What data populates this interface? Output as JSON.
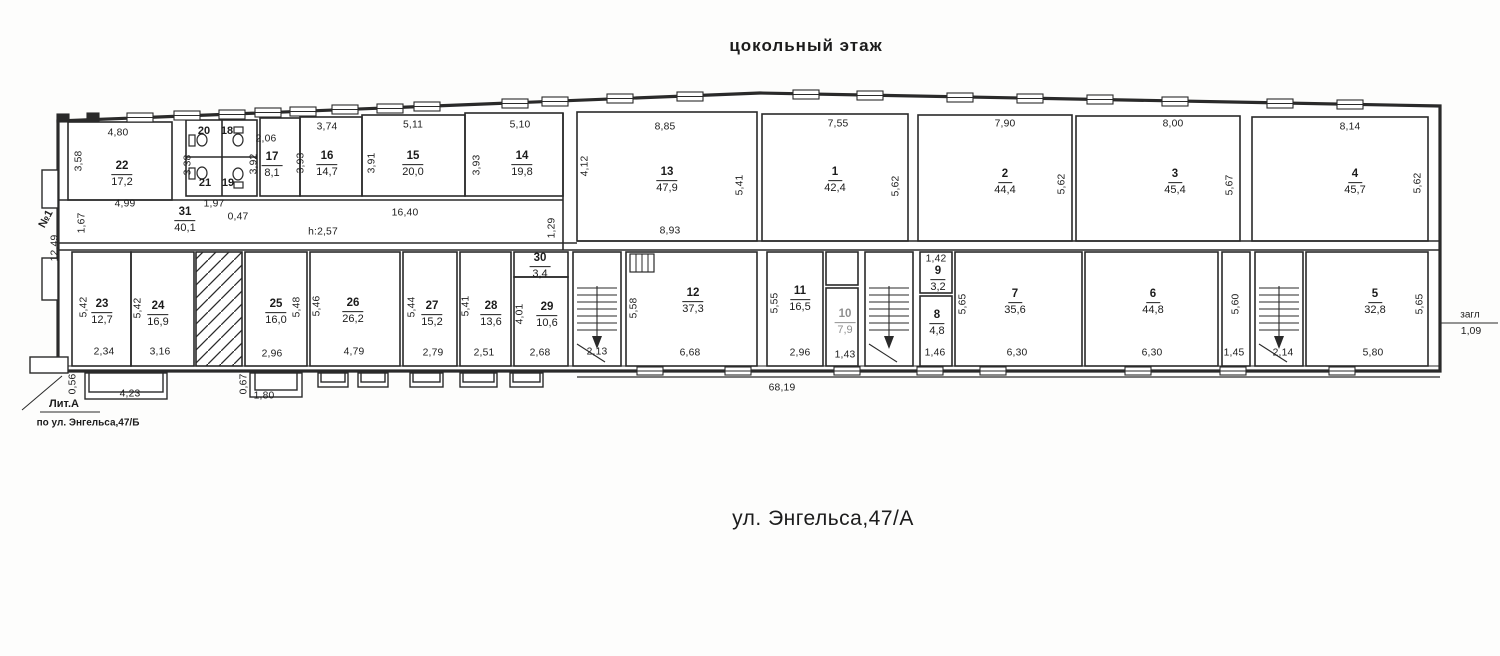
{
  "title": "цокольный  этаж",
  "address": "ул. Энгельса,47/А",
  "annotations": {
    "lit": "Лит.А",
    "street_b": "по ул. Энгельса,47/Б",
    "entrance": "№1",
    "zagl_text": "загл",
    "zagl_value": "1,09"
  },
  "rooms": [
    {
      "n": "22",
      "a": "17,2",
      "x": 122,
      "y": 172
    },
    {
      "n": "17",
      "a": "8,1",
      "x": 272,
      "y": 163
    },
    {
      "n": "16",
      "a": "14,7",
      "x": 327,
      "y": 162
    },
    {
      "n": "15",
      "a": "20,0",
      "x": 413,
      "y": 162
    },
    {
      "n": "14",
      "a": "19,8",
      "x": 522,
      "y": 162
    },
    {
      "n": "13",
      "a": "47,9",
      "x": 667,
      "y": 178
    },
    {
      "n": "1",
      "a": "42,4",
      "x": 835,
      "y": 178
    },
    {
      "n": "2",
      "a": "44,4",
      "x": 1005,
      "y": 180
    },
    {
      "n": "3",
      "a": "45,4",
      "x": 1175,
      "y": 180
    },
    {
      "n": "4",
      "a": "45,7",
      "x": 1355,
      "y": 180
    },
    {
      "n": "31",
      "a": "40,1",
      "x": 185,
      "y": 218
    },
    {
      "n": "23",
      "a": "12,7",
      "x": 102,
      "y": 310
    },
    {
      "n": "24",
      "a": "16,9",
      "x": 158,
      "y": 312
    },
    {
      "n": "25",
      "a": "16,0",
      "x": 276,
      "y": 310
    },
    {
      "n": "26",
      "a": "26,2",
      "x": 353,
      "y": 309
    },
    {
      "n": "27",
      "a": "15,2",
      "x": 432,
      "y": 312
    },
    {
      "n": "28",
      "a": "13,6",
      "x": 491,
      "y": 312
    },
    {
      "n": "29",
      "a": "10,6",
      "x": 547,
      "y": 313
    },
    {
      "n": "30",
      "a": "3,4",
      "x": 540,
      "y": 264
    },
    {
      "n": "12",
      "a": "37,3",
      "x": 693,
      "y": 299
    },
    {
      "n": "11",
      "a": "16,5",
      "x": 800,
      "y": 297
    },
    {
      "n": "10",
      "a": "7,9",
      "x": 845,
      "y": 320,
      "faint": true
    },
    {
      "n": "9",
      "a": "3,2",
      "x": 938,
      "y": 277
    },
    {
      "n": "8",
      "a": "4,8",
      "x": 937,
      "y": 321
    },
    {
      "n": "7",
      "a": "35,6",
      "x": 1015,
      "y": 300
    },
    {
      "n": "6",
      "a": "44,8",
      "x": 1153,
      "y": 300
    },
    {
      "n": "5",
      "a": "32,8",
      "x": 1375,
      "y": 300
    }
  ],
  "wc_rooms": [
    {
      "n": "20",
      "x": 204,
      "y": 131
    },
    {
      "n": "18",
      "x": 227,
      "y": 131
    },
    {
      "n": "21",
      "x": 205,
      "y": 183
    },
    {
      "n": "19",
      "x": 228,
      "y": 183
    }
  ],
  "dims": [
    {
      "t": "4,80",
      "x": 118,
      "y": 133
    },
    {
      "t": "3,58",
      "x": 79,
      "y": 161,
      "v": 1
    },
    {
      "t": "4,99",
      "x": 125,
      "y": 204
    },
    {
      "t": "1,67",
      "x": 82,
      "y": 223,
      "v": 1
    },
    {
      "t": "12,49",
      "x": 55,
      "y": 248,
      "v": 1
    },
    {
      "t": "3,38",
      "x": 188,
      "y": 165,
      "v": 1
    },
    {
      "t": "1,97",
      "x": 214,
      "y": 204
    },
    {
      "t": "0,47",
      "x": 238,
      "y": 217
    },
    {
      "t": "2,06",
      "x": 266,
      "y": 139
    },
    {
      "t": "3,92",
      "x": 254,
      "y": 164,
      "v": 1
    },
    {
      "t": "3,74",
      "x": 327,
      "y": 127
    },
    {
      "t": "3,93",
      "x": 301,
      "y": 163,
      "v": 1
    },
    {
      "t": "5,11",
      "x": 413,
      "y": 125
    },
    {
      "t": "3,91",
      "x": 372,
      "y": 163,
      "v": 1
    },
    {
      "t": "5,10",
      "x": 520,
      "y": 125
    },
    {
      "t": "3,93",
      "x": 477,
      "y": 165,
      "v": 1
    },
    {
      "t": "16,40",
      "x": 405,
      "y": 213
    },
    {
      "t": "h:2,57",
      "x": 323,
      "y": 232
    },
    {
      "t": "1,29",
      "x": 552,
      "y": 228,
      "v": 1
    },
    {
      "t": "4,12",
      "x": 585,
      "y": 166,
      "v": 1
    },
    {
      "t": "8,85",
      "x": 665,
      "y": 127
    },
    {
      "t": "8,93",
      "x": 670,
      "y": 231
    },
    {
      "t": "5,41",
      "x": 740,
      "y": 185,
      "v": 1
    },
    {
      "t": "7,55",
      "x": 838,
      "y": 124
    },
    {
      "t": "5,62",
      "x": 896,
      "y": 186,
      "v": 1
    },
    {
      "t": "7,90",
      "x": 1005,
      "y": 124
    },
    {
      "t": "5,62",
      "x": 1062,
      "y": 184,
      "v": 1
    },
    {
      "t": "8,00",
      "x": 1173,
      "y": 124
    },
    {
      "t": "5,67",
      "x": 1230,
      "y": 185,
      "v": 1
    },
    {
      "t": "8,14",
      "x": 1350,
      "y": 127
    },
    {
      "t": "5,62",
      "x": 1418,
      "y": 183,
      "v": 1
    },
    {
      "t": "5,42",
      "x": 84,
      "y": 307,
      "v": 1
    },
    {
      "t": "2,34",
      "x": 104,
      "y": 352
    },
    {
      "t": "5,42",
      "x": 138,
      "y": 308,
      "v": 1
    },
    {
      "t": "3,16",
      "x": 160,
      "y": 352
    },
    {
      "t": "2,96",
      "x": 272,
      "y": 354
    },
    {
      "t": "5,48",
      "x": 297,
      "y": 307,
      "v": 1
    },
    {
      "t": "5,46",
      "x": 317,
      "y": 306,
      "v": 1
    },
    {
      "t": "4,79",
      "x": 354,
      "y": 352
    },
    {
      "t": "5,44",
      "x": 412,
      "y": 307,
      "v": 1
    },
    {
      "t": "2,79",
      "x": 433,
      "y": 353
    },
    {
      "t": "5,41",
      "x": 466,
      "y": 306,
      "v": 1
    },
    {
      "t": "2,51",
      "x": 484,
      "y": 353
    },
    {
      "t": "4,01",
      "x": 520,
      "y": 314,
      "v": 1
    },
    {
      "t": "2,68",
      "x": 540,
      "y": 353
    },
    {
      "t": "2,13",
      "x": 597,
      "y": 352
    },
    {
      "t": "5,58",
      "x": 634,
      "y": 308,
      "v": 1
    },
    {
      "t": "6,68",
      "x": 690,
      "y": 353
    },
    {
      "t": "5,55",
      "x": 775,
      "y": 303,
      "v": 1
    },
    {
      "t": "2,96",
      "x": 800,
      "y": 353
    },
    {
      "t": "1,43",
      "x": 845,
      "y": 355
    },
    {
      "t": "1,42",
      "x": 936,
      "y": 259
    },
    {
      "t": "1,46",
      "x": 935,
      "y": 353
    },
    {
      "t": "5,65",
      "x": 963,
      "y": 304,
      "v": 1
    },
    {
      "t": "6,30",
      "x": 1017,
      "y": 353
    },
    {
      "t": "6,30",
      "x": 1152,
      "y": 353
    },
    {
      "t": "5,60",
      "x": 1236,
      "y": 304,
      "v": 1
    },
    {
      "t": "1,45",
      "x": 1234,
      "y": 353
    },
    {
      "t": "2,14",
      "x": 1283,
      "y": 353
    },
    {
      "t": "5,80",
      "x": 1373,
      "y": 353
    },
    {
      "t": "5,65",
      "x": 1420,
      "y": 304,
      "v": 1
    },
    {
      "t": "0,56",
      "x": 73,
      "y": 384,
      "v": 1
    },
    {
      "t": "4,23",
      "x": 130,
      "y": 394
    },
    {
      "t": "0,67",
      "x": 244,
      "y": 384,
      "v": 1
    },
    {
      "t": "1,80",
      "x": 264,
      "y": 396
    },
    {
      "t": "68,19",
      "x": 782,
      "y": 388
    }
  ]
}
